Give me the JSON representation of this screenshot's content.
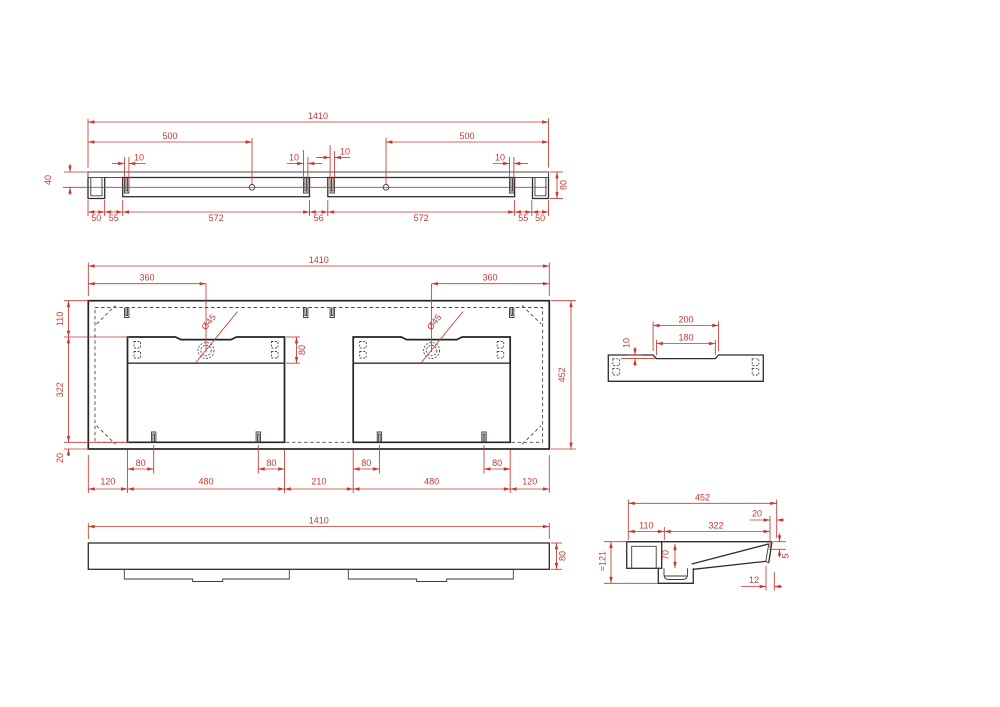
{
  "drawing": {
    "accent_color": "#c63831",
    "line_color": "#2e2e2e",
    "kind": "double-washbasin-technical-drawing"
  },
  "front": {
    "overall_width": "1410",
    "hole_offset_left": "500",
    "hole_offset_right": "500",
    "slot_widths": [
      "10",
      "10",
      "10",
      "10"
    ],
    "hole_drop": "40",
    "height": "80",
    "bottom_dims": [
      "50",
      "55",
      "572",
      "56",
      "572",
      "55",
      "50"
    ]
  },
  "plan": {
    "overall_width": "1410",
    "drain_offset_left": "360",
    "drain_offset_right": "360",
    "drain_diameters": [
      "Ø45",
      "Ø45"
    ],
    "deck_depth": "80",
    "side_dims": [
      "110",
      "322",
      "20"
    ],
    "overall_depth": "452",
    "slot_insets": [
      "80",
      "80",
      "80",
      "80"
    ],
    "bottom_dims": [
      "120",
      "480",
      "210",
      "480",
      "120"
    ]
  },
  "profile": {
    "recess_outer": "200",
    "recess_inner": "180",
    "recess_depth": "10"
  },
  "bottom_view": {
    "overall_width": "1410",
    "height": "80"
  },
  "section": {
    "overall_depth": "452",
    "rim_front": "20",
    "back_ledge": "110",
    "bowl_width": "322",
    "overall_height": "≈121",
    "bowl_depth": "70",
    "rim_thickness": "5",
    "undercut": "12"
  }
}
